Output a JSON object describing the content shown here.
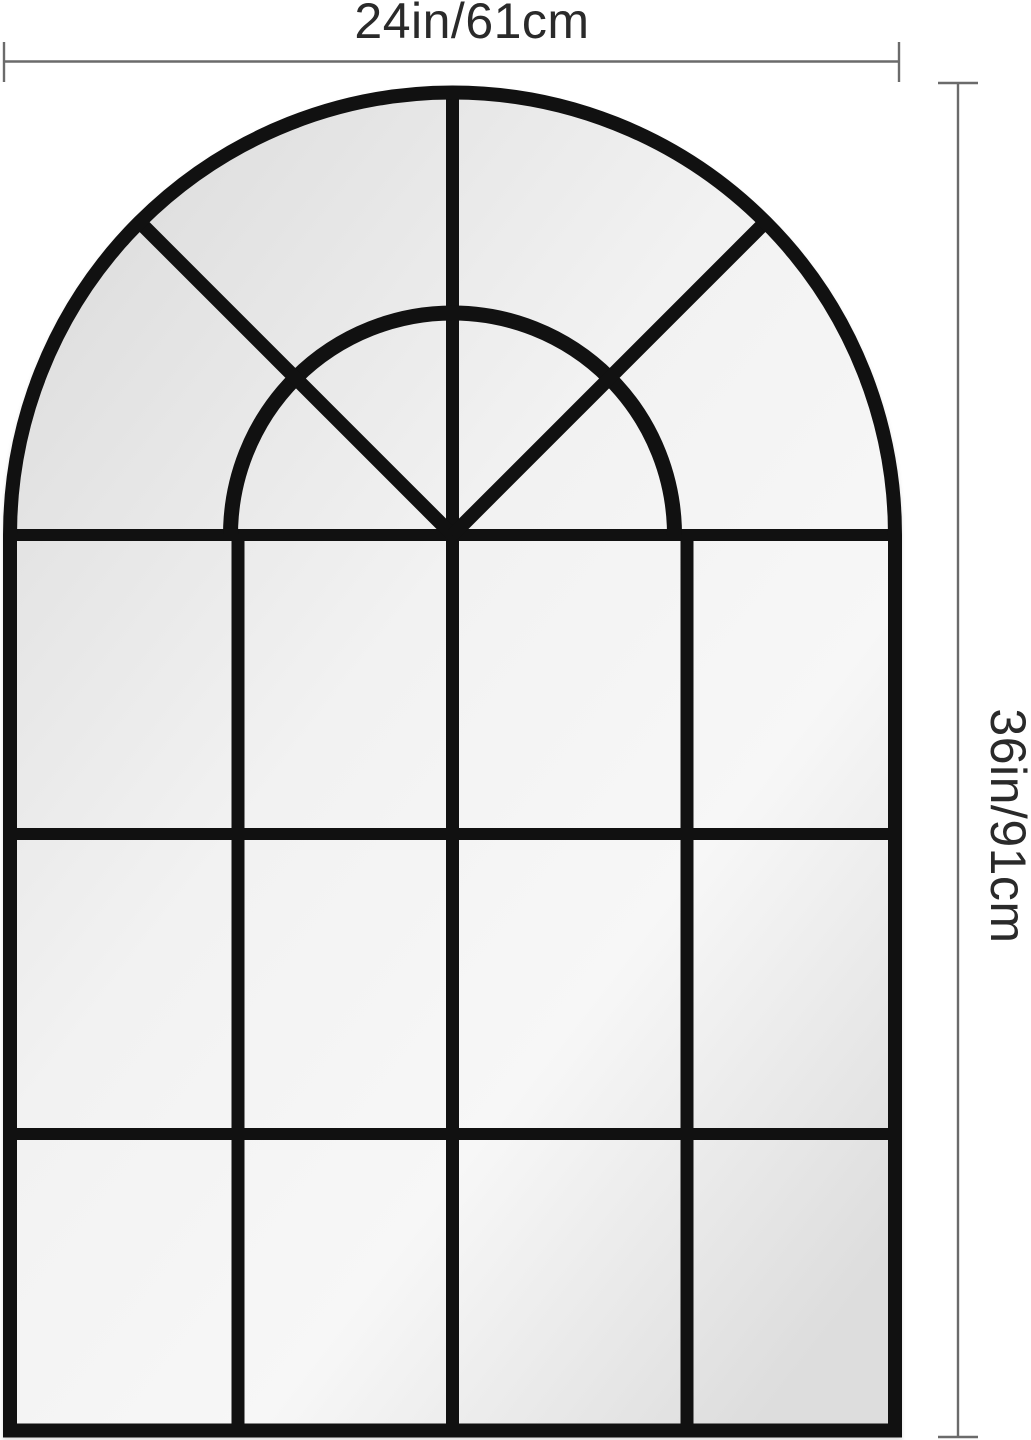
{
  "page": {
    "background": "#ffffff"
  },
  "dimensions": {
    "width_label": "24in/61cm",
    "height_label": "36in/91cm"
  },
  "mirror": {
    "description": "black arched window-pane mirror",
    "grid_columns": 4,
    "grid_rows": 3,
    "arch_features": "center mullion, inner half-round arch, two 45-degree radial spokes"
  },
  "colors": {
    "frame": "#111111",
    "dimension_line": "#6b6b6b",
    "label_text": "#2a2a2a",
    "glass_top_left": "#d9d9d9",
    "glass_mid": "#f2f2f2",
    "glass_light": "#f7f7f7",
    "glass_bottom_right": "#dddddd"
  }
}
